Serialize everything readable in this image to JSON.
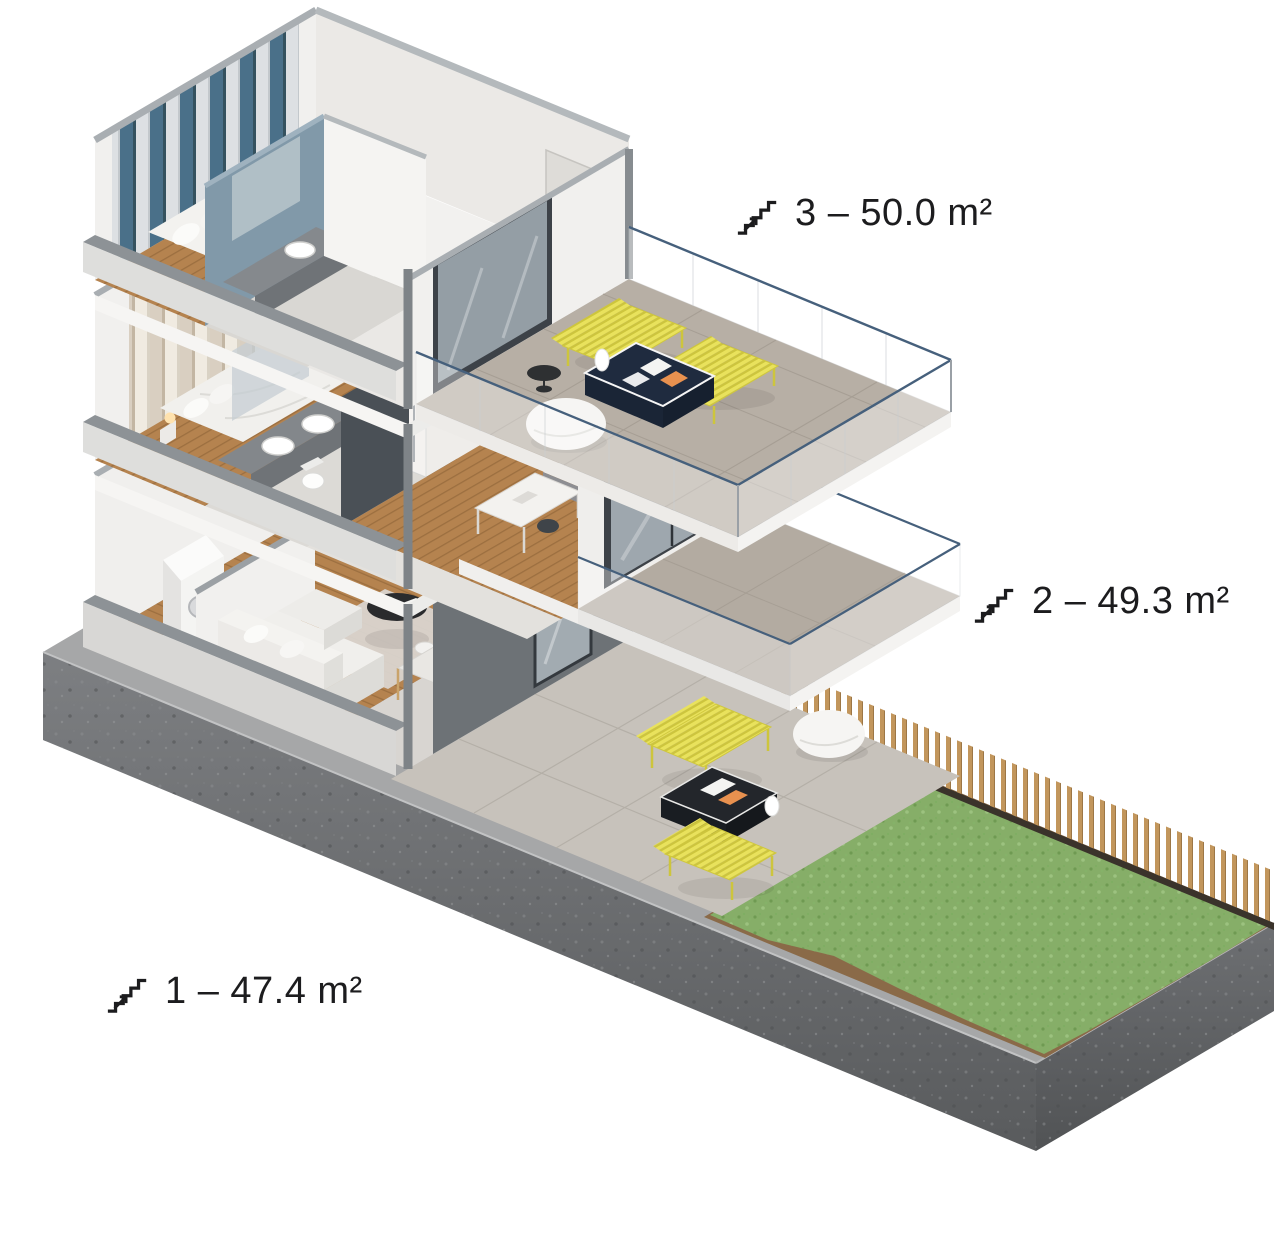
{
  "page": {
    "background": "#ffffff",
    "type": "isometric-apartment-cutaway"
  },
  "floors": [
    {
      "number": 3,
      "area_m2": 50.0,
      "label": "3 – 50.0 m²"
    },
    {
      "number": 2,
      "area_m2": 49.3,
      "label": "2 – 49.3 m²"
    },
    {
      "number": 1,
      "area_m2": 47.4,
      "label": "1 – 47.4 m²"
    }
  ],
  "icons": {
    "stairs": "stairs-with-arrow-icon"
  },
  "palette": {
    "label_text": "#1c1c1e",
    "wall_white": "#f1f0ee",
    "wall_cut_gray": "#8d9296",
    "wall_top_gray": "#a9aeb2",
    "accent_wall_blue_gray": "#8199a9",
    "dark_cut_wall": "#6d7276",
    "dark_frame": "#3d4248",
    "wood_floor": "#b5834f",
    "terrace_tile": "#b7afa5",
    "balcony_tile": "#b3aba1",
    "patio_tile": "#c7c2bb",
    "glass_rail_line": "#46607c",
    "bench_yellow": "#e9e25c",
    "coffee_table_navy": "#1f2b3f",
    "crate_black": "#23262b",
    "bed_blanket_red": "#a03441",
    "curtain_blue": "#4a7089",
    "curtain_beige": "#d9cfc1",
    "grass_green": "#86ae68",
    "soil_brown": "#8a6a48",
    "fence_wood": "#c2965c",
    "fence_base": "#3a332b",
    "concrete_dark": "#5f6163"
  }
}
